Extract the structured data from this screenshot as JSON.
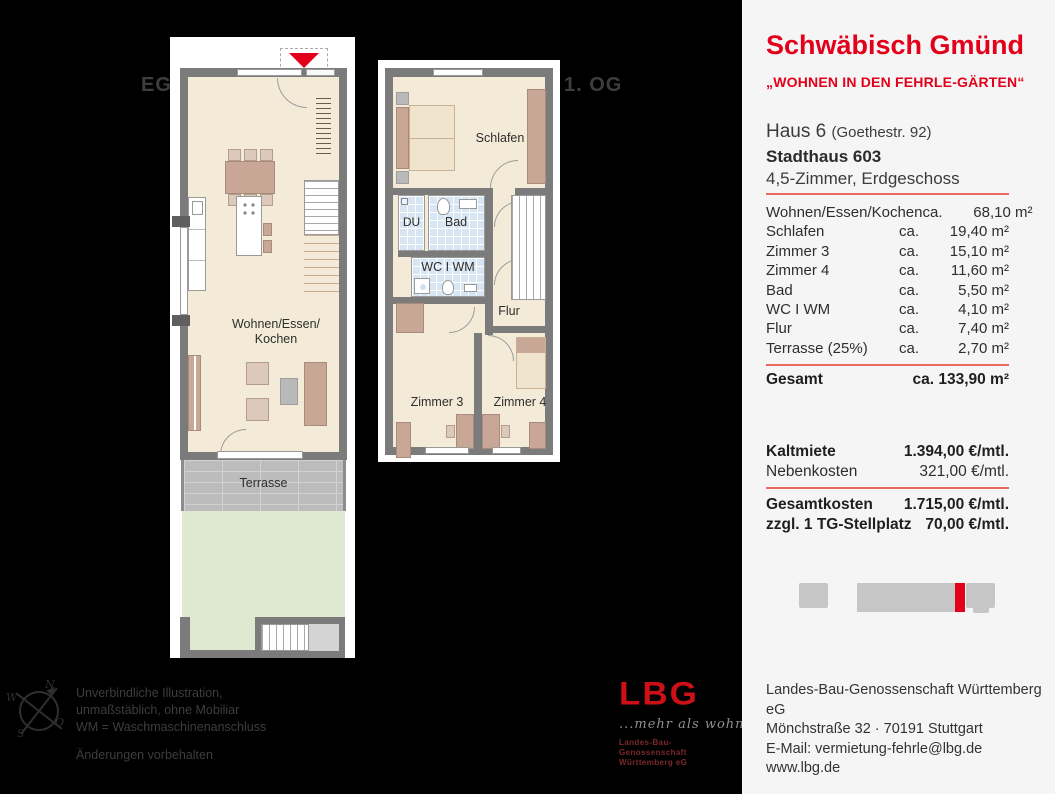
{
  "floors": {
    "eg_label": "EG",
    "og_label": "1. OG"
  },
  "plan_eg": {
    "living_label": "Wohnen/Essen/\nKochen",
    "terrace_label": "Terrasse"
  },
  "plan_og": {
    "schlafen_label": "Schlafen",
    "du_label": "DU",
    "bad_label": "Bad",
    "wc_label": "WC I WM",
    "flur_label": "Flur",
    "zimmer3_label": "Zimmer 3",
    "zimmer4_label": "Zimmer 4"
  },
  "panel": {
    "city": "Schwäbisch Gmünd",
    "project": "„WOHNEN IN DEN FEHRLE-GÄRTEN“",
    "haus": "Haus 6",
    "haus_note": "(Goethestr. 92)",
    "stadthaus": "Stadthaus 603",
    "unit_type": "4,5-Zimmer, Erdgeschoss",
    "rooms": [
      {
        "label": "Wohnen/Essen/Kochen",
        "ca": "ca.",
        "value": "68,10 m²"
      },
      {
        "label": "Schlafen",
        "ca": "ca.",
        "value": "19,40 m²"
      },
      {
        "label": "Zimmer 3",
        "ca": "ca.",
        "value": "15,10 m²"
      },
      {
        "label": "Zimmer 4",
        "ca": "ca.",
        "value": "11,60 m²"
      },
      {
        "label": "Bad",
        "ca": "ca.",
        "value": "5,50 m²"
      },
      {
        "label": "WC I WM",
        "ca": "ca.",
        "value": "4,10 m²"
      },
      {
        "label": "Flur",
        "ca": "ca.",
        "value": "7,40 m²"
      },
      {
        "label": "Terrasse (25%)",
        "ca": "ca.",
        "value": "2,70 m²"
      }
    ],
    "gesamt_label": "Gesamt",
    "gesamt_value": "ca. 133,90 m²",
    "kaltmiete_label": "Kaltmiete",
    "kaltmiete_value": "1.394,00 €/mtl.",
    "nebenkosten_label": "Nebenkosten",
    "nebenkosten_value": "321,00 €/mtl.",
    "gesamtkosten_label": "Gesamtkosten",
    "gesamtkosten_value": "1.715,00 €/mtl.",
    "stellplatz_label": "zzgl. 1 TG-Stellplatz",
    "stellplatz_value": "70,00 €/mtl.",
    "contact": [
      "Landes-Bau-Genossenschaft Württemberg eG",
      "Mönchstraße 32 · 70191 Stuttgart",
      "E-Mail: vermietung-fehrle@lbg.de",
      "www.lbg.de"
    ]
  },
  "footer": {
    "disclaimer_line1": "Unverbindliche Illustration,",
    "disclaimer_line2": "unmaßstäblich, ohne Mobiliar",
    "disclaimer_line3": "WM = Waschmaschinenanschluss",
    "note": "Änderungen vorbehalten",
    "compass": {
      "n": "N",
      "s": "S",
      "w": "W",
      "o": "O"
    }
  },
  "logo": {
    "name": "LBG",
    "tagline": "...mehr als wohnen",
    "org_line1": "Landes-Bau-Genossenschaft",
    "org_line2": "Württemberg eG"
  },
  "colors": {
    "accent_red": "#e2001a",
    "panel_bg": "#f5f5f5",
    "wall_gray": "#7b7b7b",
    "floor_beige": "#f3ebd7",
    "furniture_tan": "#c8a796",
    "tile_blue": "#d8e6f4",
    "garden_green": "#dfe9d2",
    "terrace_gray": "#bcbcbc"
  }
}
